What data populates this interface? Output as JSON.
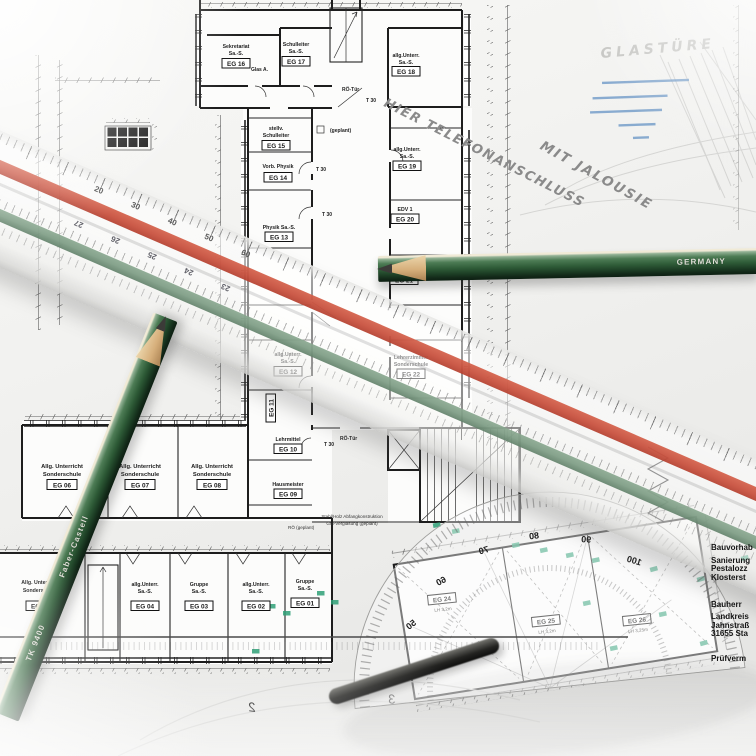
{
  "plan": {
    "rooms": [
      {
        "name1": "Sekretariat",
        "name2": "Sa.-S.",
        "id": "EG 16"
      },
      {
        "name1": "Schulleiter",
        "name2": "Sa.-S.",
        "id": "EG 17"
      },
      {
        "name1": "allg.Unterr.",
        "name2": "Sa.-S.",
        "id": "EG 18"
      },
      {
        "name1": "stellv.",
        "name2": "Schulleiter",
        "id": "EG 15"
      },
      {
        "name1": "Vorb. Physik",
        "name2": "",
        "id": "EG 14"
      },
      {
        "name1": "allg.Unterr.",
        "name2": "Sa.-S.",
        "id": "EG 19"
      },
      {
        "name1": "Physik Sa.-S.",
        "name2": "",
        "id": "EG 13"
      },
      {
        "name1": "EDV 1",
        "name2": "",
        "id": "EG 20"
      },
      {
        "name1": "EDV 2",
        "name2": "",
        "id": "EG 21"
      },
      {
        "name1": "allg.Unterr.",
        "name2": "Sa.-S.",
        "id": "EG 12"
      },
      {
        "name1": "Lehrerzimmer",
        "name2": "Sonderschule",
        "id": "EG 22"
      },
      {
        "name1": "",
        "name2": "",
        "id": "EG 11"
      },
      {
        "name1": "Lehrmittel",
        "name2": "",
        "id": "EG 10"
      },
      {
        "name1": "Hausmeister",
        "name2": "",
        "id": "EG 09"
      },
      {
        "name1": "Allg. Unterricht",
        "name2": "Sonderschule",
        "id": "EG 06"
      },
      {
        "name1": "Allg. Unterricht",
        "name2": "Sonderschule",
        "id": "EG 07"
      },
      {
        "name1": "Allg. Unterricht",
        "name2": "Sonderschule",
        "id": "EG 08"
      },
      {
        "name1": "Allg. Unterricht",
        "name2": "Sonderschule",
        "id": "EG 05"
      },
      {
        "name1": "allg.Unterr.",
        "name2": "Sa.-S.",
        "id": "EG 04"
      },
      {
        "name1": "Gruppe",
        "name2": "Sa.-S.",
        "id": "EG 03"
      },
      {
        "name1": "allg.Unterr.",
        "name2": "Sa.-S.",
        "id": "EG 02"
      },
      {
        "name1": "Gruppe",
        "name2": "Sa.-S.",
        "id": "EG 01"
      },
      {
        "id": "EG 24",
        "sub": "LH 3,2m"
      },
      {
        "id": "EG 25",
        "sub": "LH 3,2m"
      },
      {
        "id": "EG 26",
        "sub": "LH 3,25m"
      }
    ],
    "notes": {
      "glas_a": "Glas A.",
      "geplant": "(geplant)",
      "roe_tuer": "RÖ-Tür",
      "t30": "T 30",
      "abfang": "Stahl/Holz Abfangkonstruktion",
      "verglasung": "GM-Verglasung (geplant)",
      "roe_geplant": "RÖ (geplant)"
    }
  },
  "handwriting": {
    "telefon": "HIER TELEFONANSCHLUSS",
    "jalousie": "MIT JALOUSIE",
    "glastuere": "GLASTÜRE"
  },
  "title_block": {
    "project_label": "Bauvorhab",
    "lines1": [
      "Sanierung",
      "Pestalozz",
      "Klosterst"
    ],
    "owner_label": "Bauherr",
    "lines2": [
      "Landkreis",
      "Jahnstraß",
      "31655 Sta"
    ],
    "check_label": "Prüfverm"
  },
  "tools": {
    "scale_ruler": {
      "red_scale": [
        "20",
        "30",
        "40",
        "50",
        "60"
      ],
      "green_scale": [
        "27",
        "26",
        "25",
        "24",
        "23"
      ]
    },
    "pencil_left": {
      "brand": "Faber-Castell",
      "model": "TK 9400"
    },
    "pencil_right": {
      "origin": "GERMANY"
    },
    "protractor": {
      "labels": [
        "50",
        "60",
        "70",
        "80",
        "90",
        "100"
      ]
    },
    "ghost_scale": [
      "2",
      "3"
    ]
  },
  "colors": {
    "ruler_red": "#c8503c",
    "ruler_green": "#7d9c84",
    "pencil_green": "#2d5a38",
    "highlight_green": "#2fa077",
    "highlight_blue": "#6f9ac8",
    "handwriting_gray": "#8a8a8a",
    "ink": "#1c1c1c"
  }
}
